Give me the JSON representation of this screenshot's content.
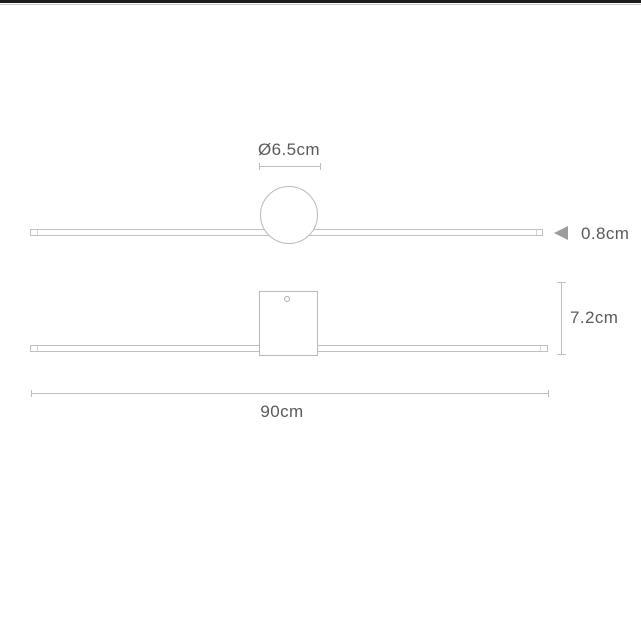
{
  "diagram": {
    "type": "product-dimension-drawing",
    "subject": "linear-wall-light",
    "front_view": {
      "canopy_shape": "circle",
      "diameter_label": "Ø6.5cm",
      "thickness_label": "0.8cm"
    },
    "side_view": {
      "canopy_shape": "square",
      "height_label": "7.2cm",
      "width_label": "90cm"
    },
    "colors": {
      "outline": "#c0c0c0",
      "dimension_line": "#bdbdbd",
      "text": "#5a5a5a",
      "arrow": "#9c9c9c",
      "top_edge": "#1d1d1d",
      "background": "#ffffff"
    }
  }
}
